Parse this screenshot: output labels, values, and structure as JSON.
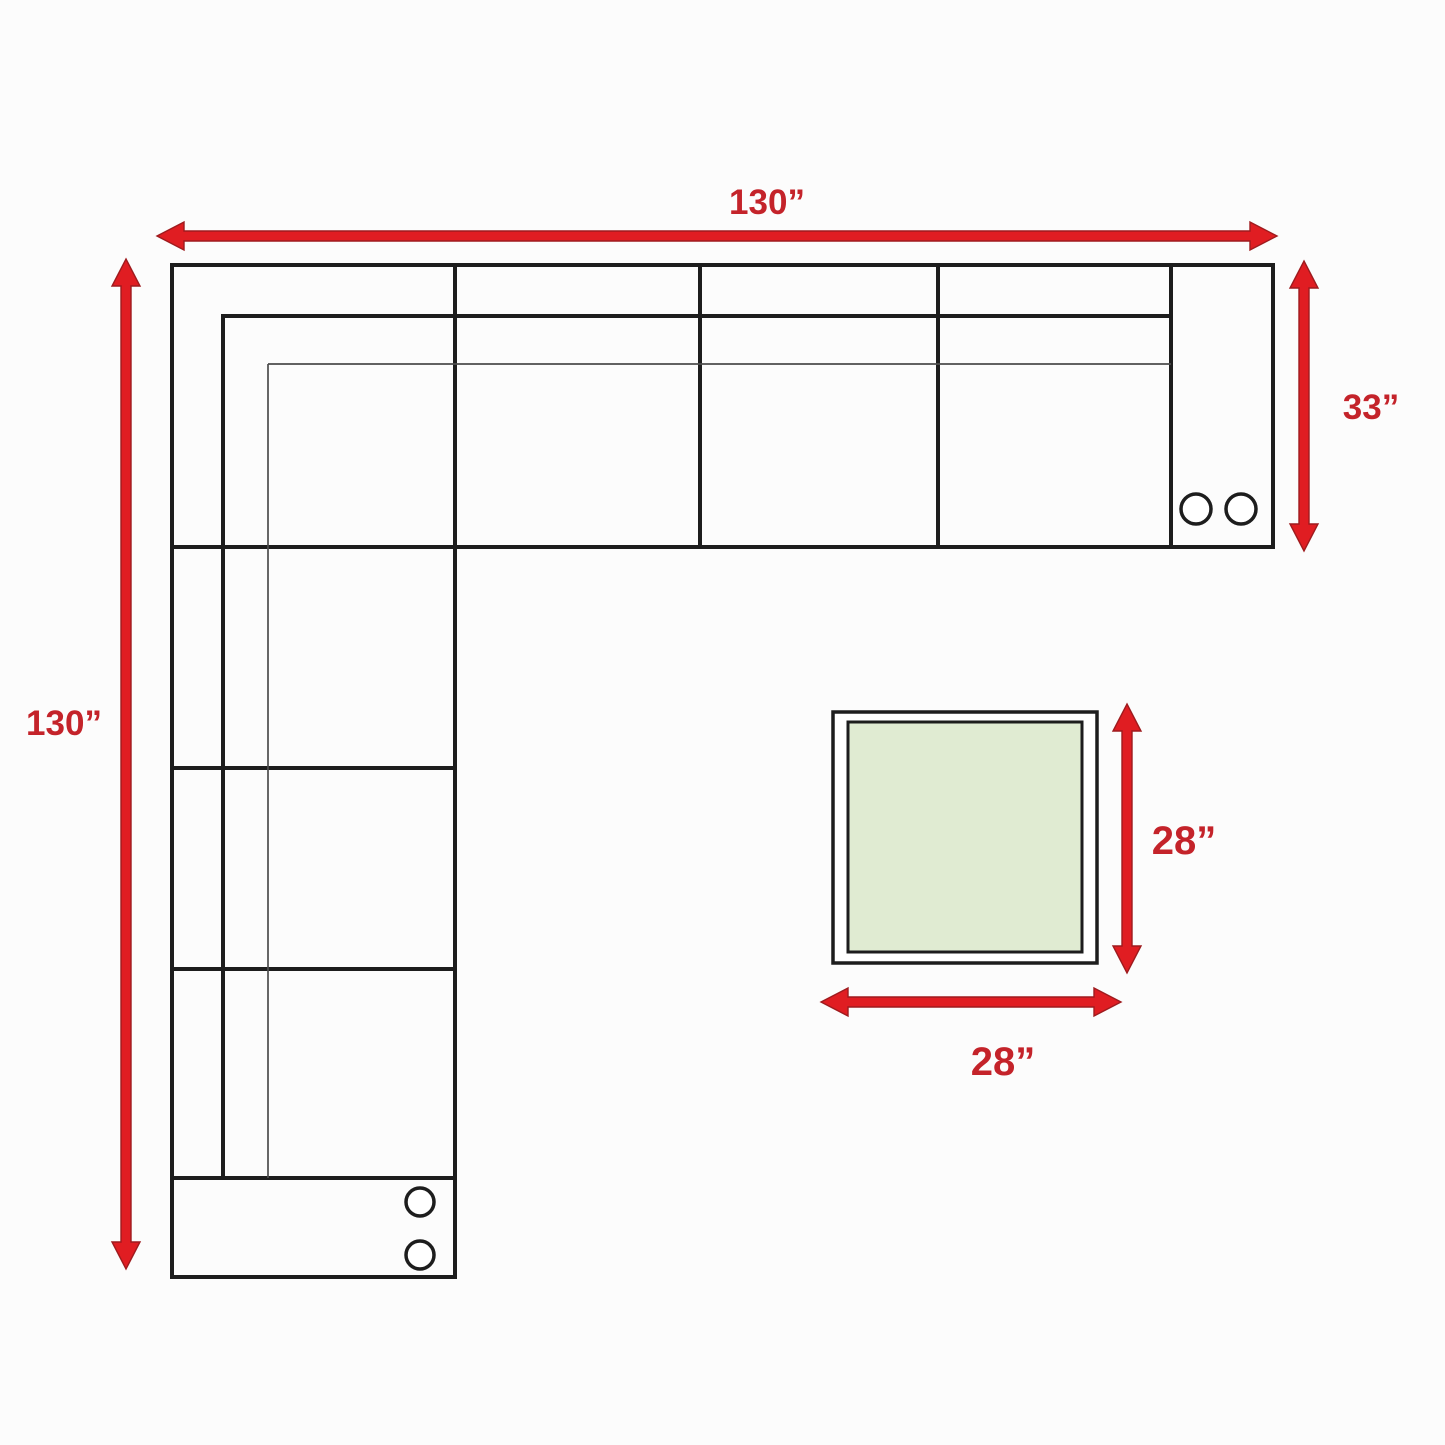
{
  "dimensions": {
    "sofa_total_width": "130”",
    "sofa_total_length": "130”",
    "sofa_depth": "33”",
    "table_depth": "28”",
    "table_width": "28”"
  },
  "colors": {
    "arrow": "#e01d22",
    "arrow_edge": "#9e1b1e",
    "label": "#c4232a",
    "line": "#1d1d1d",
    "thin_line": "#4d4d4d",
    "table_fill": "#e0ebd2",
    "background": "#fcfcfc"
  }
}
